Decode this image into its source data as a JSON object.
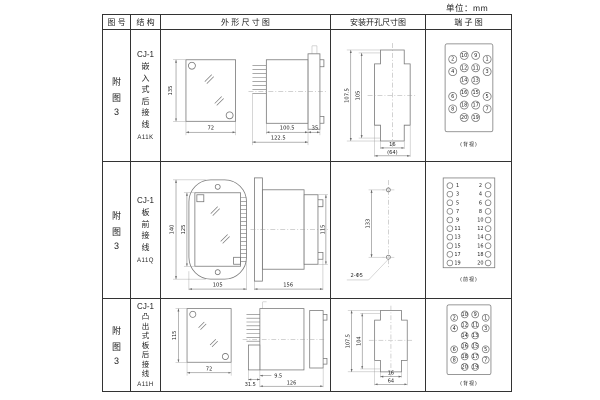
{
  "unit_label": "单位：mm",
  "table": {
    "headers": {
      "figure": "图 号",
      "structure": "结 构",
      "outline": "外 形 尺 寸 图",
      "install": "安装开孔尺寸图",
      "terminal": "端 子 图"
    },
    "rows": [
      {
        "figure": [
          "附",
          "图",
          "3"
        ],
        "structure_title": "CJ-1",
        "structure_chars": [
          "嵌",
          "入",
          "式",
          "后",
          "接",
          "线"
        ],
        "model": "A11K",
        "outline": {
          "front_h": "135",
          "front_w": "72",
          "d1": "100.5",
          "d2": "122.5",
          "d3": "35"
        },
        "install": {
          "v1": "107.5",
          "v2": "105",
          "h1": "16",
          "h2": "(64)"
        },
        "terminal": {
          "layout": "staggered",
          "view": "(背视)",
          "rows": [
            [
              "2",
              "10",
              "9",
              "1"
            ],
            [
              "4",
              "12",
              "11",
              "3"
            ],
            [
              "",
              "14",
              "13",
              ""
            ],
            [
              "6",
              "16",
              "15",
              "5"
            ],
            [
              "8",
              "18",
              "17",
              "7"
            ],
            [
              "",
              "20",
              "19",
              ""
            ]
          ]
        }
      },
      {
        "figure": [
          "附",
          "图",
          "3"
        ],
        "structure_title": "CJ-1",
        "structure_chars": [
          "板",
          "前",
          "接",
          "线"
        ],
        "model": "A11Q",
        "outline": {
          "front_h": "140",
          "front_h2": "125",
          "front_w": "105",
          "d1": "156",
          "side_h": "115"
        },
        "install": {
          "v1": "133",
          "hole": "2-Φ5"
        },
        "terminal": {
          "layout": "columns",
          "view": "(前视)",
          "left": [
            "1",
            "3",
            "5",
            "7",
            "9",
            "11",
            "13",
            "15",
            "17",
            "19"
          ],
          "right": [
            "2",
            "4",
            "6",
            "8",
            "10",
            "12",
            "14",
            "16",
            "18",
            "20"
          ]
        }
      },
      {
        "figure": [
          "附",
          "图",
          "3"
        ],
        "structure_title": "CJ-1",
        "structure_chars": [
          "凸",
          "出",
          "式",
          "板",
          "后",
          "接",
          "线"
        ],
        "model": "A11H",
        "outline": {
          "front_h": "115",
          "front_w": "72",
          "d1": "31.5",
          "d2": "9.5",
          "d3": "126"
        },
        "install": {
          "v1": "107.5",
          "v2": "104",
          "h1": "16",
          "h2": "64"
        },
        "terminal": {
          "layout": "staggered",
          "view": "(背视)",
          "rows": [
            [
              "2",
              "10",
              "9",
              "1"
            ],
            [
              "4",
              "12",
              "11",
              "3"
            ],
            [
              "",
              "14",
              "13",
              ""
            ],
            [
              "6",
              "16",
              "15",
              "5"
            ],
            [
              "8",
              "18",
              "17",
              "7"
            ],
            [
              "",
              "20",
              "19",
              ""
            ]
          ]
        }
      }
    ]
  }
}
